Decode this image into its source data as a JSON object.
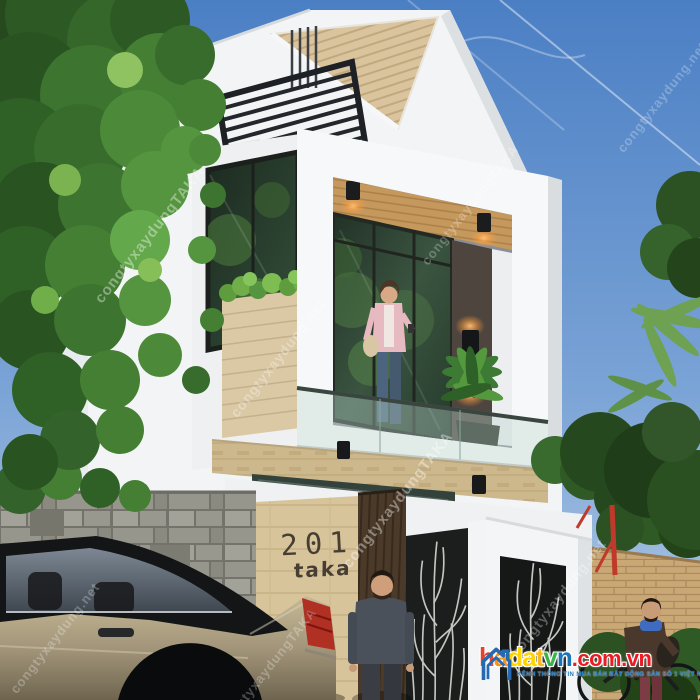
{
  "scene": {
    "type": "3d-architectural-render",
    "subject": "Modern white two-storey townhouse with wood accents, balcony, black louver canopy, decorative metal gates, sedan car parked in front, trees on both sides"
  },
  "colors": {
    "sky_top": "#4b7fc4",
    "sky_bottom": "#b6cde6",
    "wall_white": "#f4f5f6",
    "roof_wood": "#d8c29a",
    "ceiling_wood": "#c5995e",
    "canopy_black": "#23272b",
    "travertine_band": "#cdb88e",
    "sign_wall": "#d8c49a",
    "door_wood": "#4b3a29",
    "stone_wall": "#8f8e85",
    "brick_wall": "#c9a876",
    "foliage": "#447f33",
    "car_body": "#ab9e81",
    "taillight": "#b03024",
    "lamp_glow": "#ffc37a"
  },
  "house": {
    "number": "201",
    "name": "taka"
  },
  "watermarks": {
    "brand": "congtyxaydungTAKA",
    "site": "congtyxaydung.net"
  },
  "logo": {
    "icon": "house-outline-icon",
    "icon_color": "#2569b3",
    "letters": [
      {
        "ch": "h",
        "color": "#e8402a"
      },
      {
        "ch": "a",
        "color": "#f7941d"
      },
      {
        "ch": "d",
        "color": "#ffd400"
      },
      {
        "ch": "a",
        "color": "#ffd400"
      },
      {
        "ch": "t",
        "color": "#f9b81e"
      },
      {
        "ch": "v",
        "color": "#39b54a"
      },
      {
        "ch": "n",
        "color": "#1b75bb"
      }
    ],
    "domain": ".com.vn",
    "domain_color": "#ed1c24",
    "tagline": "KÊNH THÔNG TIN MUA BÁN BẤT ĐỘNG SẢN SỐ 1 VIỆT NAM",
    "tagline_color": "#1b75bb"
  }
}
